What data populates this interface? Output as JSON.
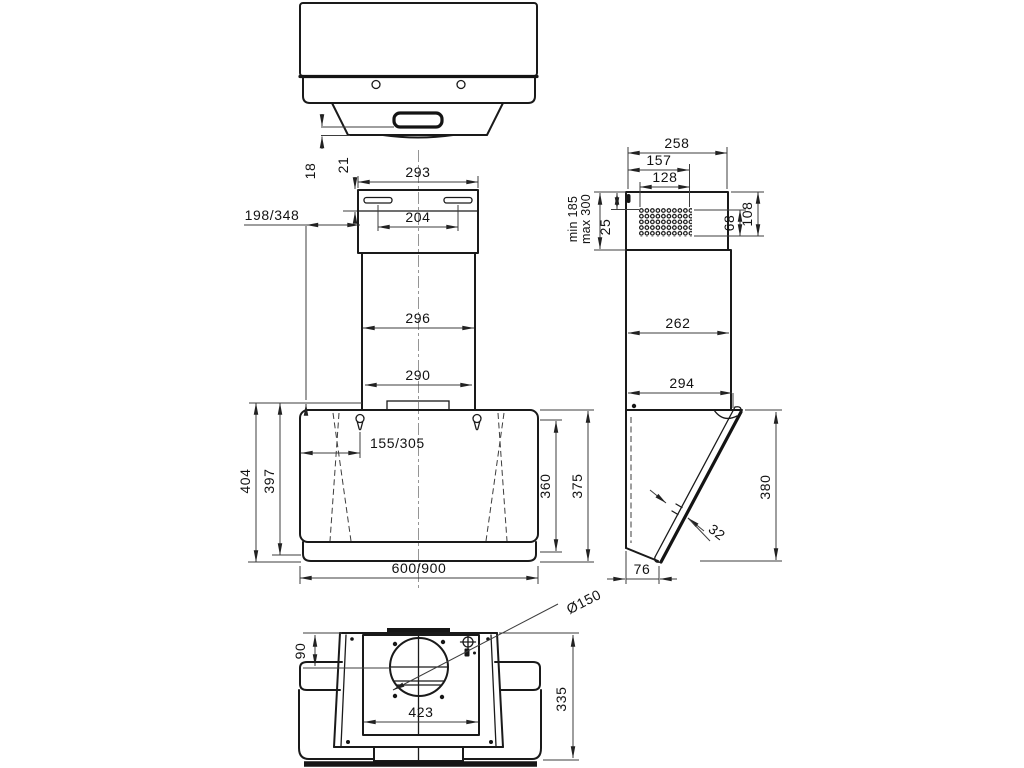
{
  "drawing": {
    "top_view": {
      "slot_height": "18",
      "flange_height": "21"
    },
    "front_view": {
      "chimney_top_width": "293",
      "bracket_hole_spacing": "204",
      "wall_offset": "198/348",
      "chimney_lower_width": "296",
      "chimney_base_width": "290",
      "hook_offset": "155/305",
      "total_height": "404",
      "body_height": "397",
      "glass_height": "360",
      "front_height": "375",
      "hood_width": "600/900"
    },
    "side_view": {
      "top_depth": "258",
      "vent_width": "157",
      "perforation_width": "128",
      "telescopic_min": "min 185",
      "telescopic_max": "max 300",
      "vent_top_offset": "25",
      "perforation_height": "68",
      "vent_zone_height": "108",
      "chimney_depth": "262",
      "body_depth": "294",
      "glass_length": "380",
      "glass_thickness": "32",
      "body_bottom_depth": "76"
    },
    "bottom_view": {
      "duct_diameter": "Ø150",
      "duct_offset": "90",
      "opening_width": "423",
      "body_depth": "335"
    }
  }
}
